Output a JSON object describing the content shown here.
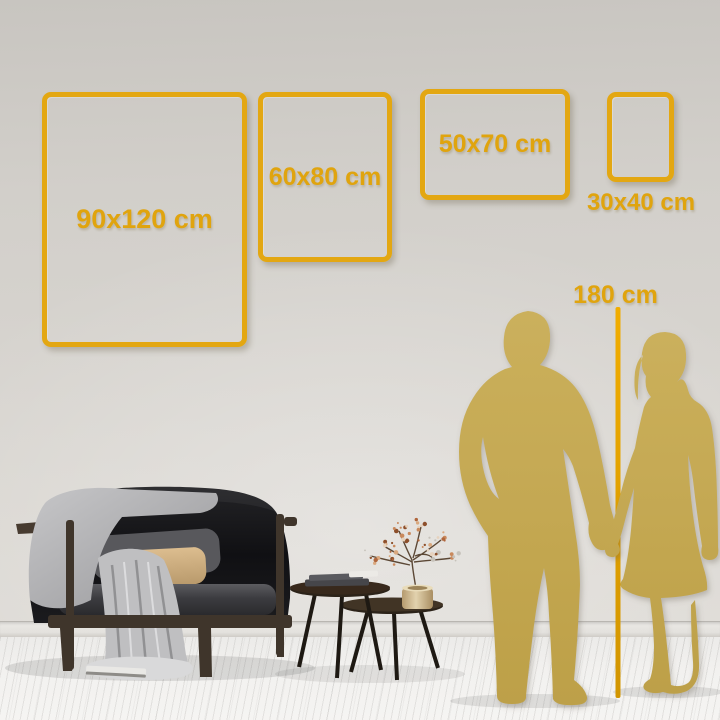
{
  "size_guide": {
    "frames": [
      {
        "id": "90x120",
        "label": "90x120 cm",
        "orientation": "portrait",
        "label_placement": "inside"
      },
      {
        "id": "60x80",
        "label": "60x80 cm",
        "orientation": "portrait",
        "label_placement": "inside"
      },
      {
        "id": "50x70",
        "label": "50x70 cm",
        "orientation": "landscape",
        "label_placement": "inside"
      },
      {
        "id": "30x40",
        "label": "30x40 cm",
        "orientation": "portrait",
        "label_placement": "below"
      }
    ],
    "height_reference": {
      "label": "180 cm",
      "subject": "couple-silhouette"
    }
  },
  "colors": {
    "accent_gold": "#E3A712",
    "silhouette_gold": "#C4A851",
    "wall": "#D6D3CE",
    "floor": "#F1F0EE",
    "sofa_black": "#17171A"
  },
  "scene": {
    "objects": [
      "black-loveseat-sofa",
      "gray-blanket",
      "gray-pillow",
      "beige-pillow",
      "nesting-coffee-tables",
      "book-stack",
      "brass-vase-dried-branch",
      "couple-silhouette",
      "height-measure-line",
      "plank-floor",
      "baseboard"
    ]
  }
}
